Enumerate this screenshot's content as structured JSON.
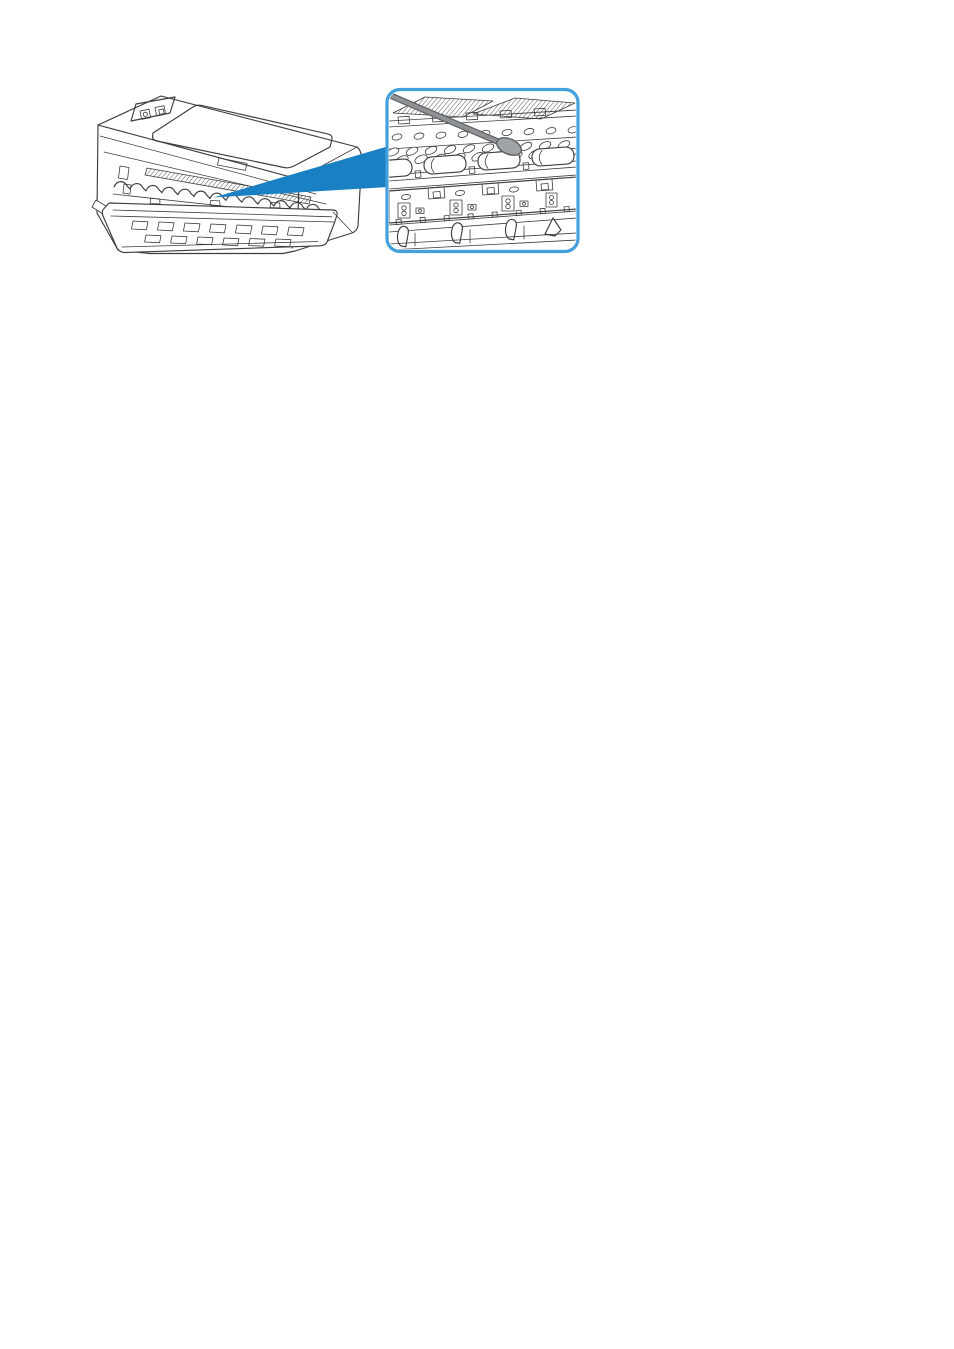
{
  "page": {
    "background": "#ffffff"
  },
  "figure": {
    "name": "printer-inside-cleaning-illustration",
    "description": "Line drawing of a compact inkjet printer with its front cover open; a blue magnifier wedge points to a rounded blue callout showing a close-up of the paper feed rollers inside being cleaned with a cotton swab",
    "printer": {
      "label": "printer-with-open-front-cover"
    },
    "callout": {
      "label": "magnified-view-of-rollers"
    },
    "swab": {
      "label": "cotton-swab"
    },
    "colors": {
      "line": "#3d3d3d",
      "accent_blue": "#1a80c4",
      "callout_border": "#42a0da",
      "swab_stick": "#8f9396",
      "swab_outline": "#5d6164",
      "swab_tip": "#9fa3a6",
      "white": "#ffffff"
    }
  }
}
